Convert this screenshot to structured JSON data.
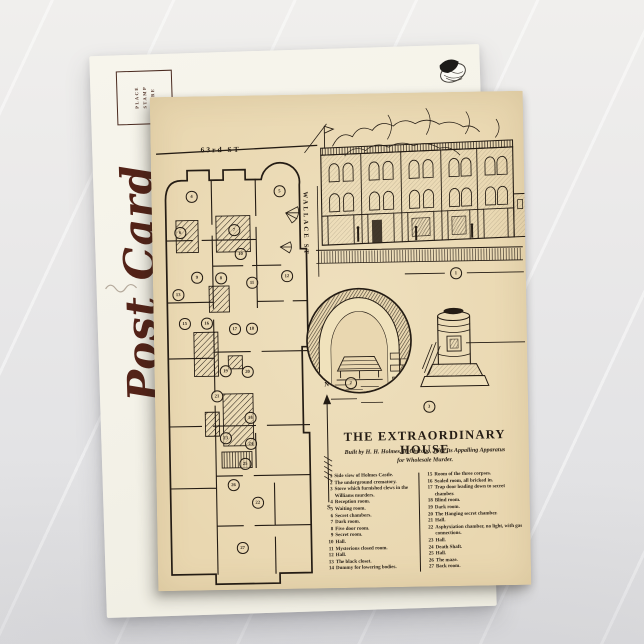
{
  "back_card": {
    "script_text": "Post Card",
    "stamp_box_lines": [
      "PLACE",
      "STAMP",
      "HERE"
    ]
  },
  "front_card": {
    "street_top": "63rd ST",
    "street_side": "WALLACE ST",
    "compass_n": "N",
    "compass_s": "S",
    "title": "THE EXTRAORDINARY HOUSE",
    "subtitle_line1": "Built by H. H. Holmes, in Chicago, With Its Appalling Apparatus",
    "subtitle_line2": "for Wholesale Murder.",
    "legend_left": [
      {
        "n": "1",
        "text": "Side view of Holmes Castle."
      },
      {
        "n": "2",
        "text": "The underground crematory."
      },
      {
        "n": "3",
        "text": "Stove which furnished clews in the Williams murders."
      },
      {
        "n": "4",
        "text": "Reception room."
      },
      {
        "n": "5",
        "text": "Waiting room."
      },
      {
        "n": "6",
        "text": "Secret chambers."
      },
      {
        "n": "7",
        "text": "Dark room."
      },
      {
        "n": "8",
        "text": "Five door room."
      },
      {
        "n": "9",
        "text": "Secret room."
      },
      {
        "n": "10",
        "text": "Hall."
      },
      {
        "n": "11",
        "text": "Mysterious closed room."
      },
      {
        "n": "12",
        "text": "Hall."
      },
      {
        "n": "13",
        "text": "The black closet."
      },
      {
        "n": "14",
        "text": "Dummy for lowering bodies."
      }
    ],
    "legend_right": [
      {
        "n": "15",
        "text": "Room of the three corpses."
      },
      {
        "n": "16",
        "text": "Sealed room, all bricked in."
      },
      {
        "n": "17",
        "text": "Trap door leading down to secret chamber."
      },
      {
        "n": "18",
        "text": "Blind room."
      },
      {
        "n": "19",
        "text": "Dark room."
      },
      {
        "n": "20",
        "text": "The Hanging secret chamber."
      },
      {
        "n": "21",
        "text": "Hall."
      },
      {
        "n": "22",
        "text": "Asphyxiation chamber, no light, with gas connections."
      },
      {
        "n": "23",
        "text": "Hall."
      },
      {
        "n": "24",
        "text": "Death Shaft."
      },
      {
        "n": "25",
        "text": "Hall."
      },
      {
        "n": "26",
        "text": "The maze."
      },
      {
        "n": "27",
        "text": "Back room."
      }
    ],
    "plan_markers": [
      {
        "n": "1",
        "x": 303,
        "y": 181
      },
      {
        "n": "2",
        "x": 196,
        "y": 289
      },
      {
        "n": "3",
        "x": 274,
        "y": 314
      },
      {
        "n": "4",
        "x": 40,
        "y": 100
      },
      {
        "n": "5",
        "x": 128,
        "y": 96
      },
      {
        "n": "6",
        "x": 28,
        "y": 136
      },
      {
        "n": "7",
        "x": 82,
        "y": 134
      },
      {
        "n": "8",
        "x": 68,
        "y": 182
      },
      {
        "n": "9",
        "x": 44,
        "y": 181
      },
      {
        "n": "10",
        "x": 88,
        "y": 158
      },
      {
        "n": "11",
        "x": 99,
        "y": 187
      },
      {
        "n": "12",
        "x": 134,
        "y": 181
      },
      {
        "n": "13",
        "x": 25,
        "y": 198
      },
      {
        "n": "14",
        "x": 95,
        "y": 322
      },
      {
        "n": "15",
        "x": 31,
        "y": 227
      },
      {
        "n": "16",
        "x": 53,
        "y": 227
      },
      {
        "n": "17",
        "x": 81,
        "y": 233
      },
      {
        "n": "18",
        "x": 98,
        "y": 233
      },
      {
        "n": "19",
        "x": 71,
        "y": 275
      },
      {
        "n": "20",
        "x": 93,
        "y": 276
      },
      {
        "n": "21",
        "x": 62,
        "y": 300
      },
      {
        "n": "22",
        "x": 101,
        "y": 407
      },
      {
        "n": "23",
        "x": 70,
        "y": 342
      },
      {
        "n": "24",
        "x": 95,
        "y": 348
      },
      {
        "n": "25",
        "x": 89,
        "y": 368
      },
      {
        "n": "26",
        "x": 77,
        "y": 389
      },
      {
        "n": "27",
        "x": 85,
        "y": 452
      }
    ],
    "colors": {
      "ink": "#241c14",
      "card": "#e9d7b0",
      "script": "#542318",
      "stamp_ink": "#4a2a20"
    }
  }
}
